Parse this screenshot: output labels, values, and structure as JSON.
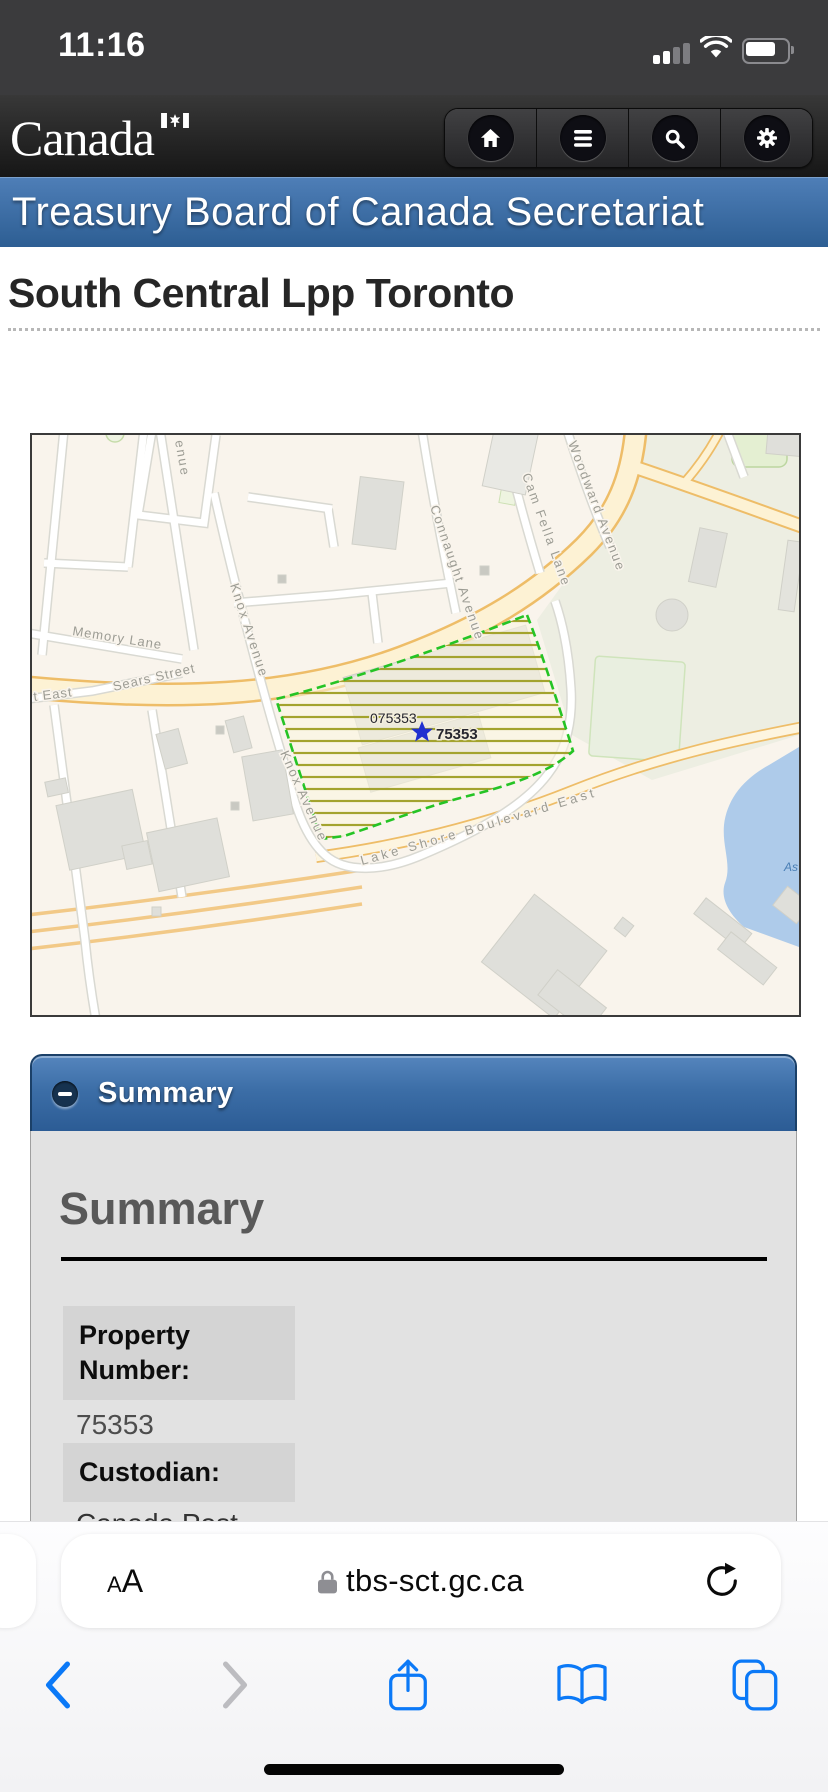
{
  "status_bar": {
    "time": "11:16"
  },
  "nav": {
    "wordmark": "Canada",
    "buttons": [
      {
        "label": "home"
      },
      {
        "label": "menu"
      },
      {
        "label": "search"
      },
      {
        "label": "settings"
      }
    ]
  },
  "banner": {
    "title": "Treasury Board of Canada Secretariat"
  },
  "page": {
    "title": "South Central Lpp Toronto"
  },
  "map": {
    "streets": {
      "partial_avenue": "enue",
      "knox_upper": "Knox Avenue",
      "knox_lower": "Knox Avenue",
      "connaught": "Connaught Avenue",
      "cam_fella": "Cam Fella Lane",
      "woodward": "Woodward Avenue",
      "memory": "Memory Lane",
      "sears": "Sears Street",
      "street_east_partial": "t East",
      "lake_shore": "Lake Shore Boulevard East"
    },
    "water_label_partial": "As",
    "property": {
      "parcel_label": "075353",
      "point_label": "75353"
    }
  },
  "summary": {
    "accordion_title": "Summary",
    "heading": "Summary",
    "fields": [
      {
        "label": "Property Number:",
        "value": "75353"
      },
      {
        "label": "Custodian:",
        "value": "Canada Post"
      }
    ]
  },
  "browser": {
    "reader_button": "AA",
    "url": "tbs-sct.gc.ca"
  },
  "colors": {
    "banner_blue": "#2d5e93",
    "safari_blue": "#0b79f7",
    "parcel_outline_green": "#25c425",
    "parcel_hatch_olive": "#a3a32e",
    "star_blue": "#2030d0"
  }
}
